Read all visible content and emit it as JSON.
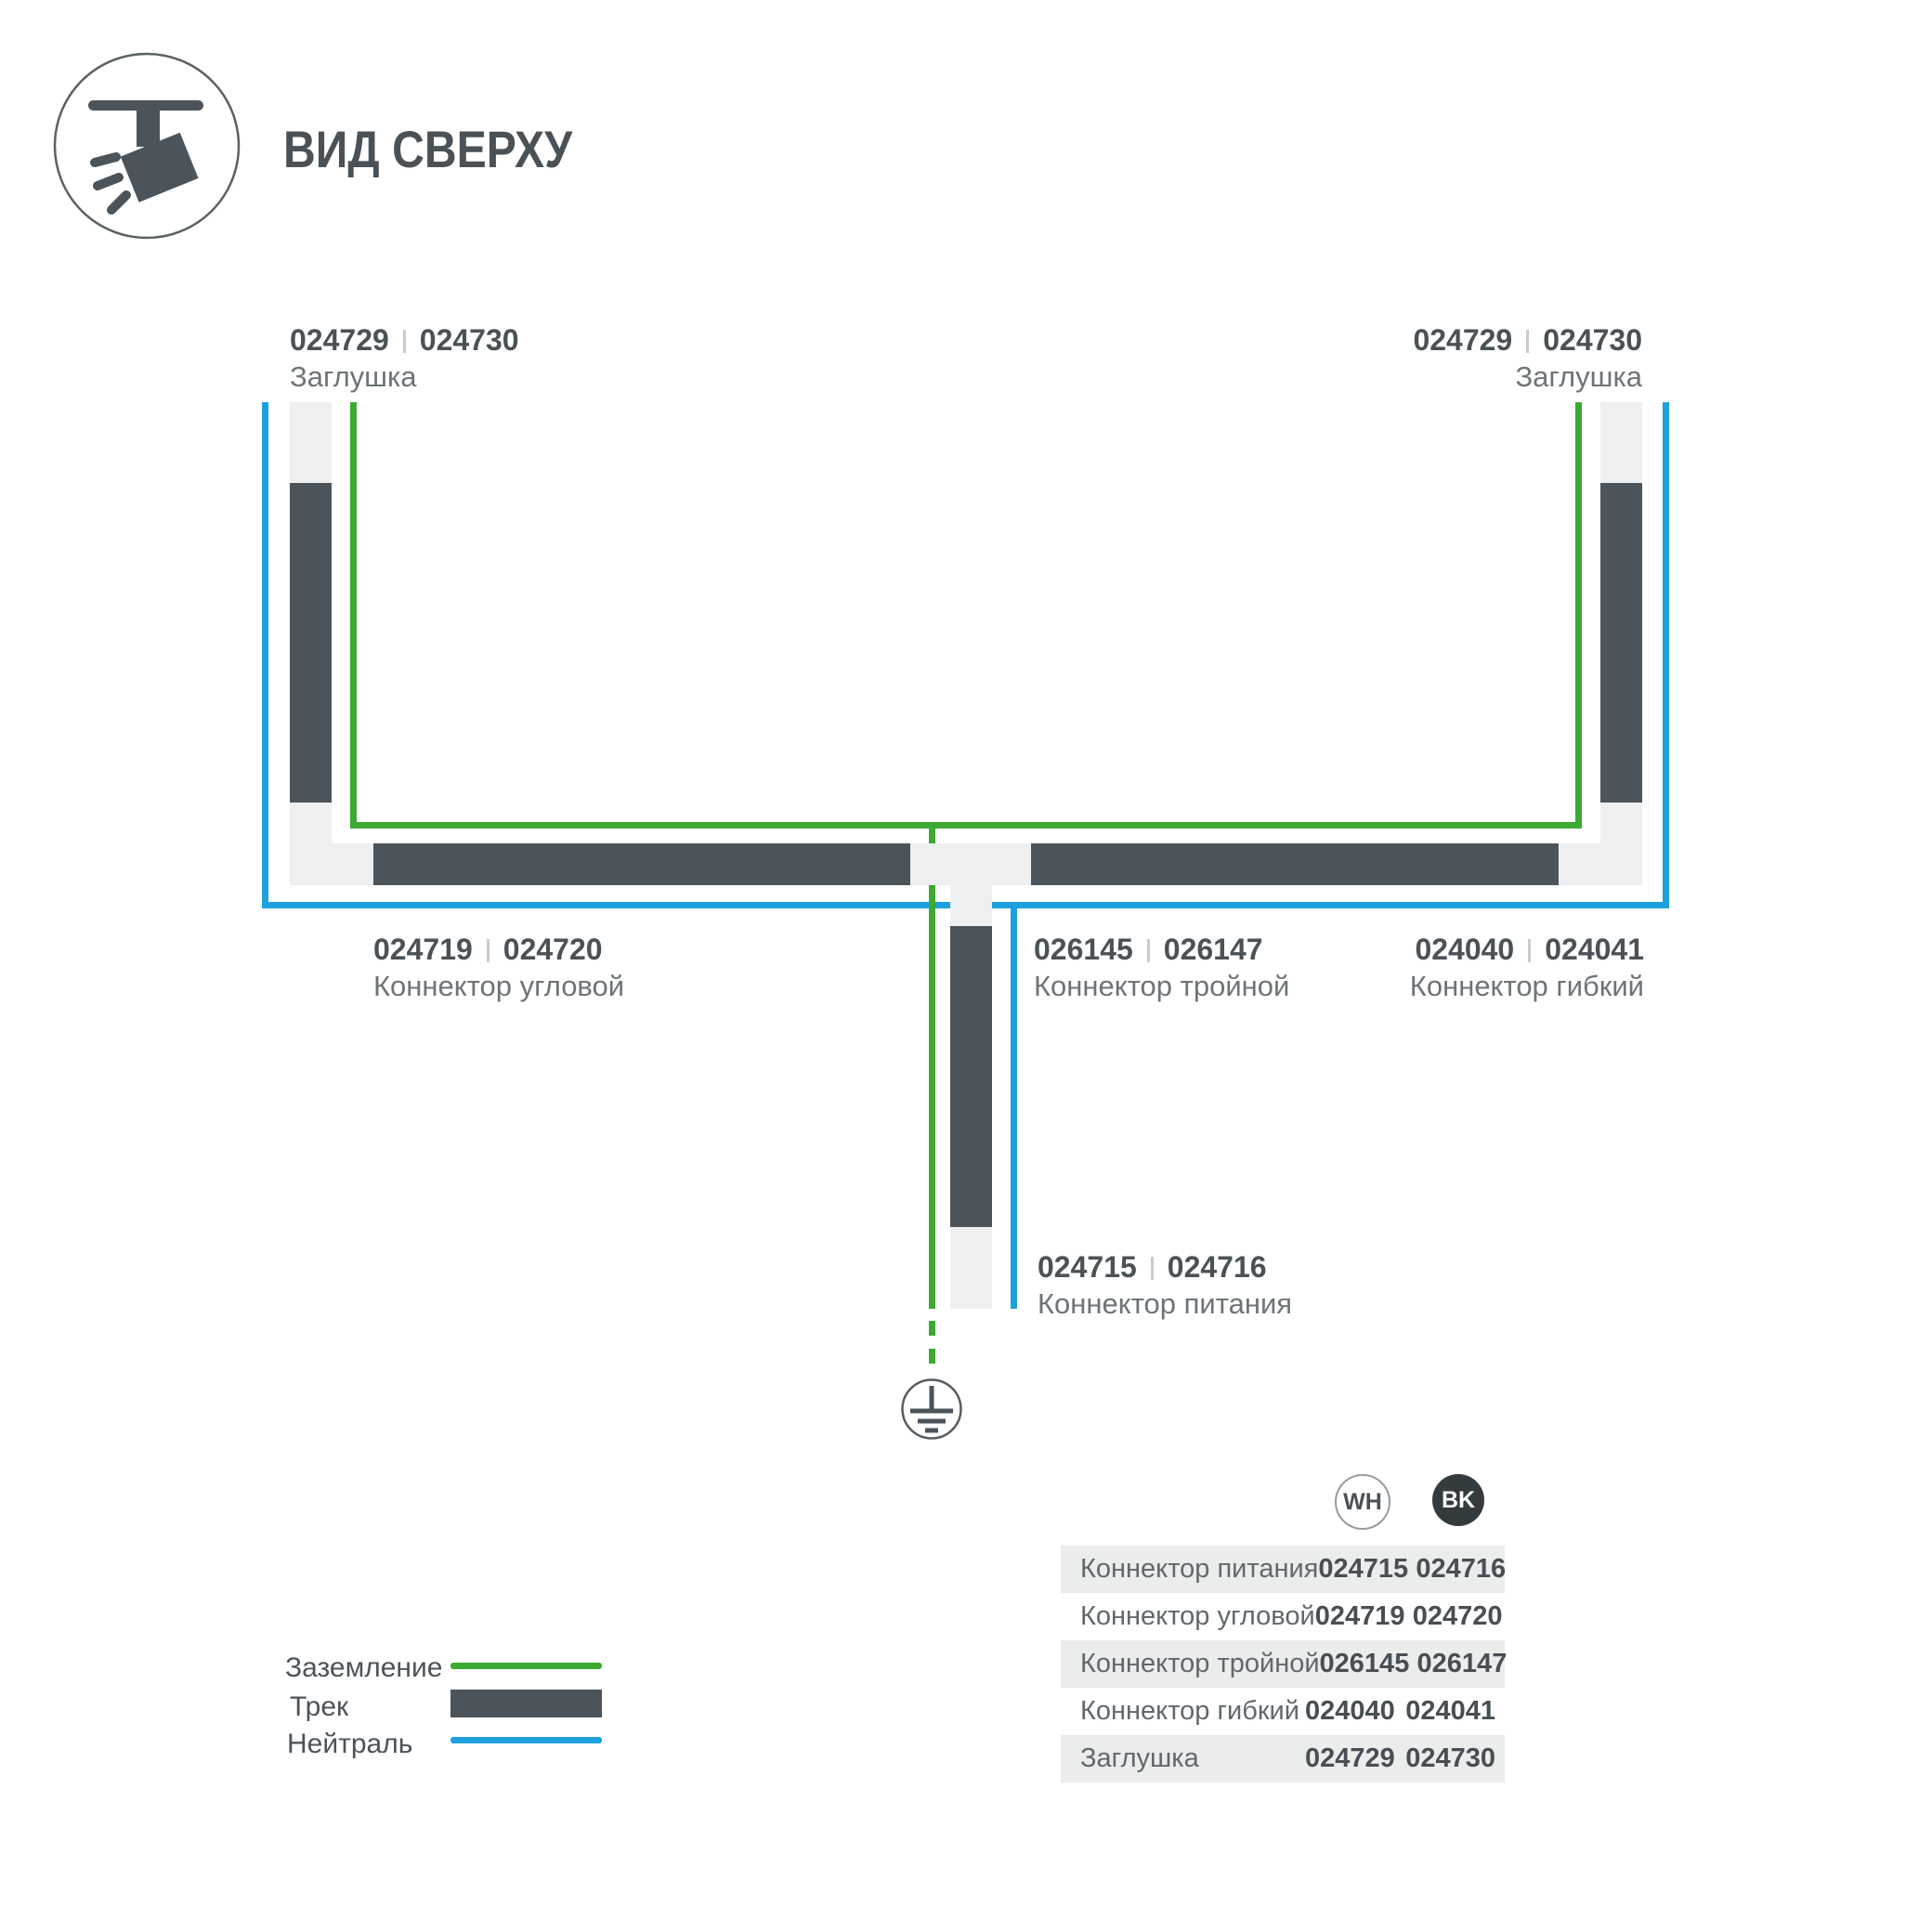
{
  "header": {
    "title": "ВИД СВЕРХУ",
    "icon": "ceiling-track-spotlight"
  },
  "diagram": {
    "labels": {
      "cap_left": {
        "wh": "024729",
        "bk": "024730",
        "name": "Заглушка"
      },
      "cap_right": {
        "wh": "024729",
        "bk": "024730",
        "name": "Заглушка"
      },
      "corner": {
        "wh": "024719",
        "bk": "024720",
        "name": "Коннектор угловой"
      },
      "triple": {
        "wh": "026145",
        "bk": "026147",
        "name": "Коннектор тройной"
      },
      "flex": {
        "wh": "024040",
        "bk": "024041",
        "name": "Коннектор гибкий"
      },
      "power": {
        "wh": "024715",
        "bk": "024716",
        "name": "Коннектор питания"
      }
    },
    "ground_icon": "earth-ground-symbol"
  },
  "legend": {
    "items": [
      {
        "label": "Заземление",
        "swatch": "ground-green-line",
        "color": "#3caa32"
      },
      {
        "label": "Трек",
        "swatch": "track-dark-bar",
        "color": "#4b545a"
      },
      {
        "label": "Нейтраль",
        "swatch": "neutral-blue-line",
        "color": "#1da1dc"
      }
    ]
  },
  "table": {
    "columns": [
      {
        "code": "WH"
      },
      {
        "code": "BK"
      }
    ],
    "rows": [
      {
        "name": "Коннектор питания",
        "wh": "024715",
        "bk": "024716"
      },
      {
        "name": "Коннектор угловой",
        "wh": "024719",
        "bk": "024720"
      },
      {
        "name": "Коннектор тройной",
        "wh": "026145",
        "bk": "026147"
      },
      {
        "name": "Коннектор гибкий",
        "wh": "024040",
        "bk": "024041"
      },
      {
        "name": "Заглушка",
        "wh": "024729",
        "bk": "024730"
      }
    ]
  },
  "colors": {
    "ground_green": "#3caa32",
    "neutral_blue": "#1da1dc",
    "track_dark": "#4b545a",
    "connector_light": "#edeff0",
    "table_row_gray": "#ebecec",
    "badge_bk_fill": "#343b3f"
  }
}
